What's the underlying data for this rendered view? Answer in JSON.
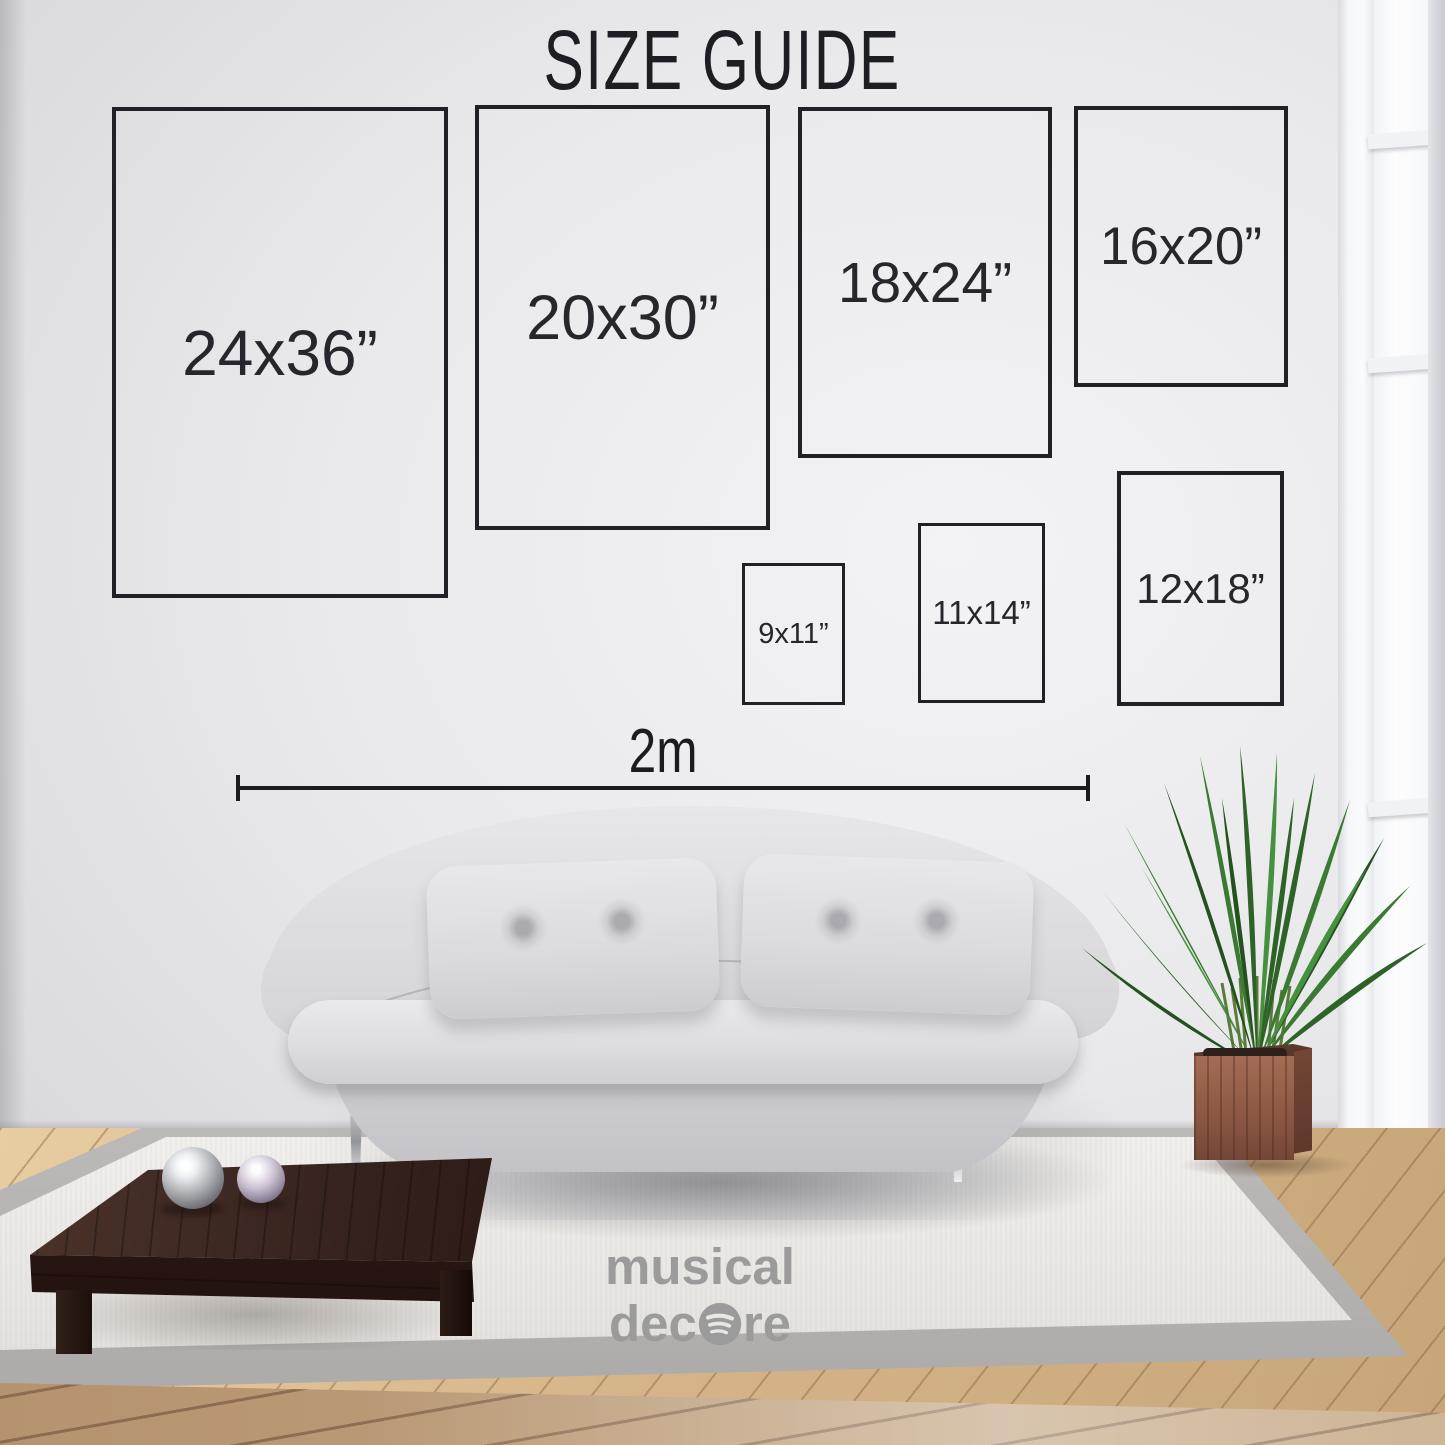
{
  "title": "SIZE GUIDE",
  "size_guide": {
    "frames": [
      {
        "id": "24x36",
        "label": "24x36”"
      },
      {
        "id": "20x30",
        "label": "20x30”"
      },
      {
        "id": "18x24",
        "label": "18x24”"
      },
      {
        "id": "16x20",
        "label": "16x20”"
      },
      {
        "id": "9x11",
        "label": "9x11”"
      },
      {
        "id": "11x14",
        "label": "11x14”"
      },
      {
        "id": "12x18",
        "label": "12x18”"
      }
    ],
    "scale_bar": {
      "label": "2m"
    }
  },
  "brand": {
    "line1": "musical",
    "line2_prefix": "dec",
    "line2_suffix": "re",
    "o_icon": "spotify-style-sound-wave-icon"
  },
  "icons": {
    "logo_o": "spotify-icon"
  },
  "colors": {
    "frame_outline": "#202126",
    "frame_label": "#26272c",
    "title_text": "#1d1e23",
    "measure_line": "#1b1c20",
    "logo_gray": "#9c9b9b",
    "wall_light": "#e9e9eb",
    "sofa_gray": "#d9d8db",
    "rug": "#eae8e4",
    "rug_border": "#b0aeac",
    "floor_wood": "#d6b588",
    "table_wood": "#3a2520",
    "planter_wood": "#8a5743",
    "plant_green": "#2f6b2a"
  }
}
